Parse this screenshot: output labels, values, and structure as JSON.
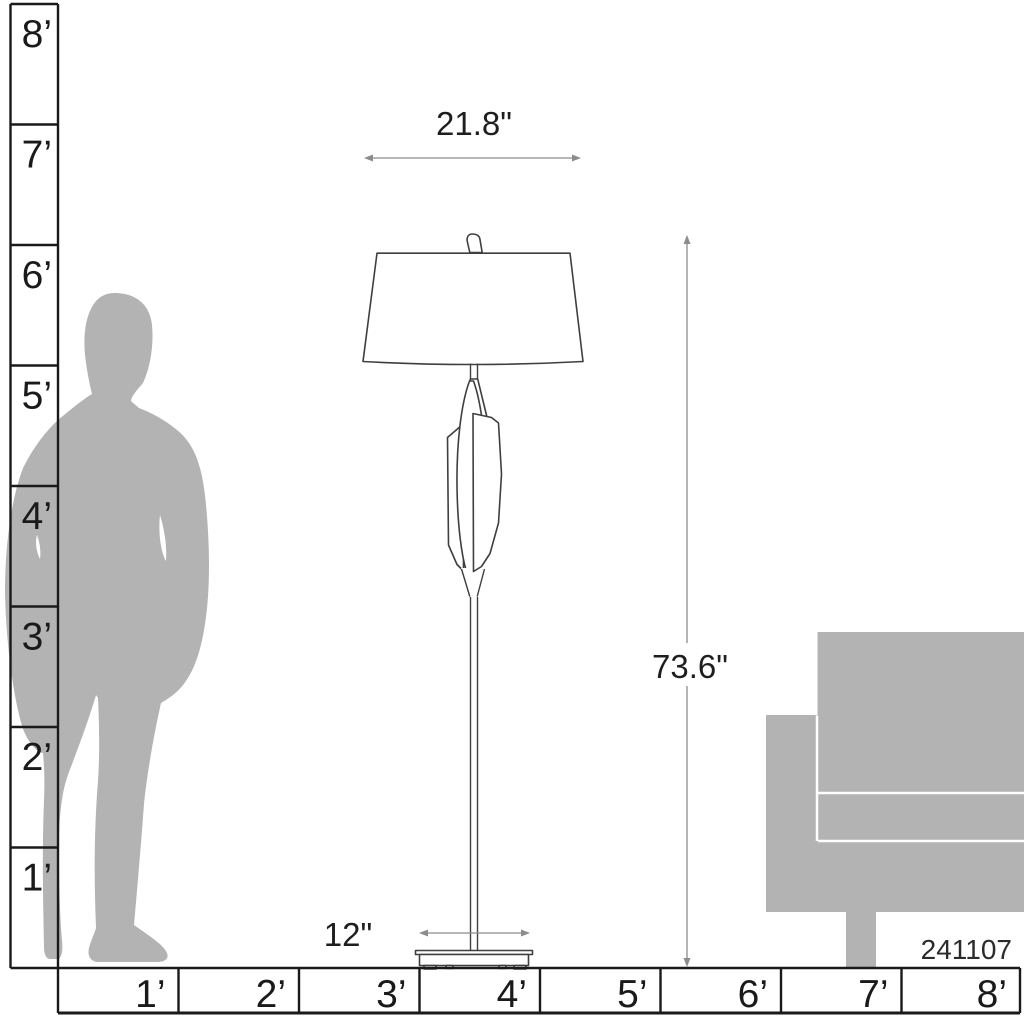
{
  "figure": {
    "type": "product scale diagram",
    "product_model": "241107"
  },
  "dimensions": {
    "shade_width": "21.8\"",
    "overall_height": "73.6\"",
    "base_width": "12\""
  },
  "rulers": {
    "vertical": {
      "unit": "feet",
      "labels": [
        "8’",
        "7’",
        "6’",
        "5’",
        "4’",
        "3’",
        "2’",
        "1’"
      ]
    },
    "horizontal": {
      "unit": "feet",
      "labels": [
        "1’",
        "2’",
        "3’",
        "4’",
        "5’",
        "6’",
        "7’",
        "8’"
      ]
    }
  },
  "colors": {
    "background": "#ffffff",
    "silhouette": "#b3b3b3",
    "ruler_line": "#1a1a1a",
    "lamp_outline": "#3f3f3f",
    "dimension_arrow": "#8c8c8c",
    "dimension_text": "#1e1e1e"
  }
}
